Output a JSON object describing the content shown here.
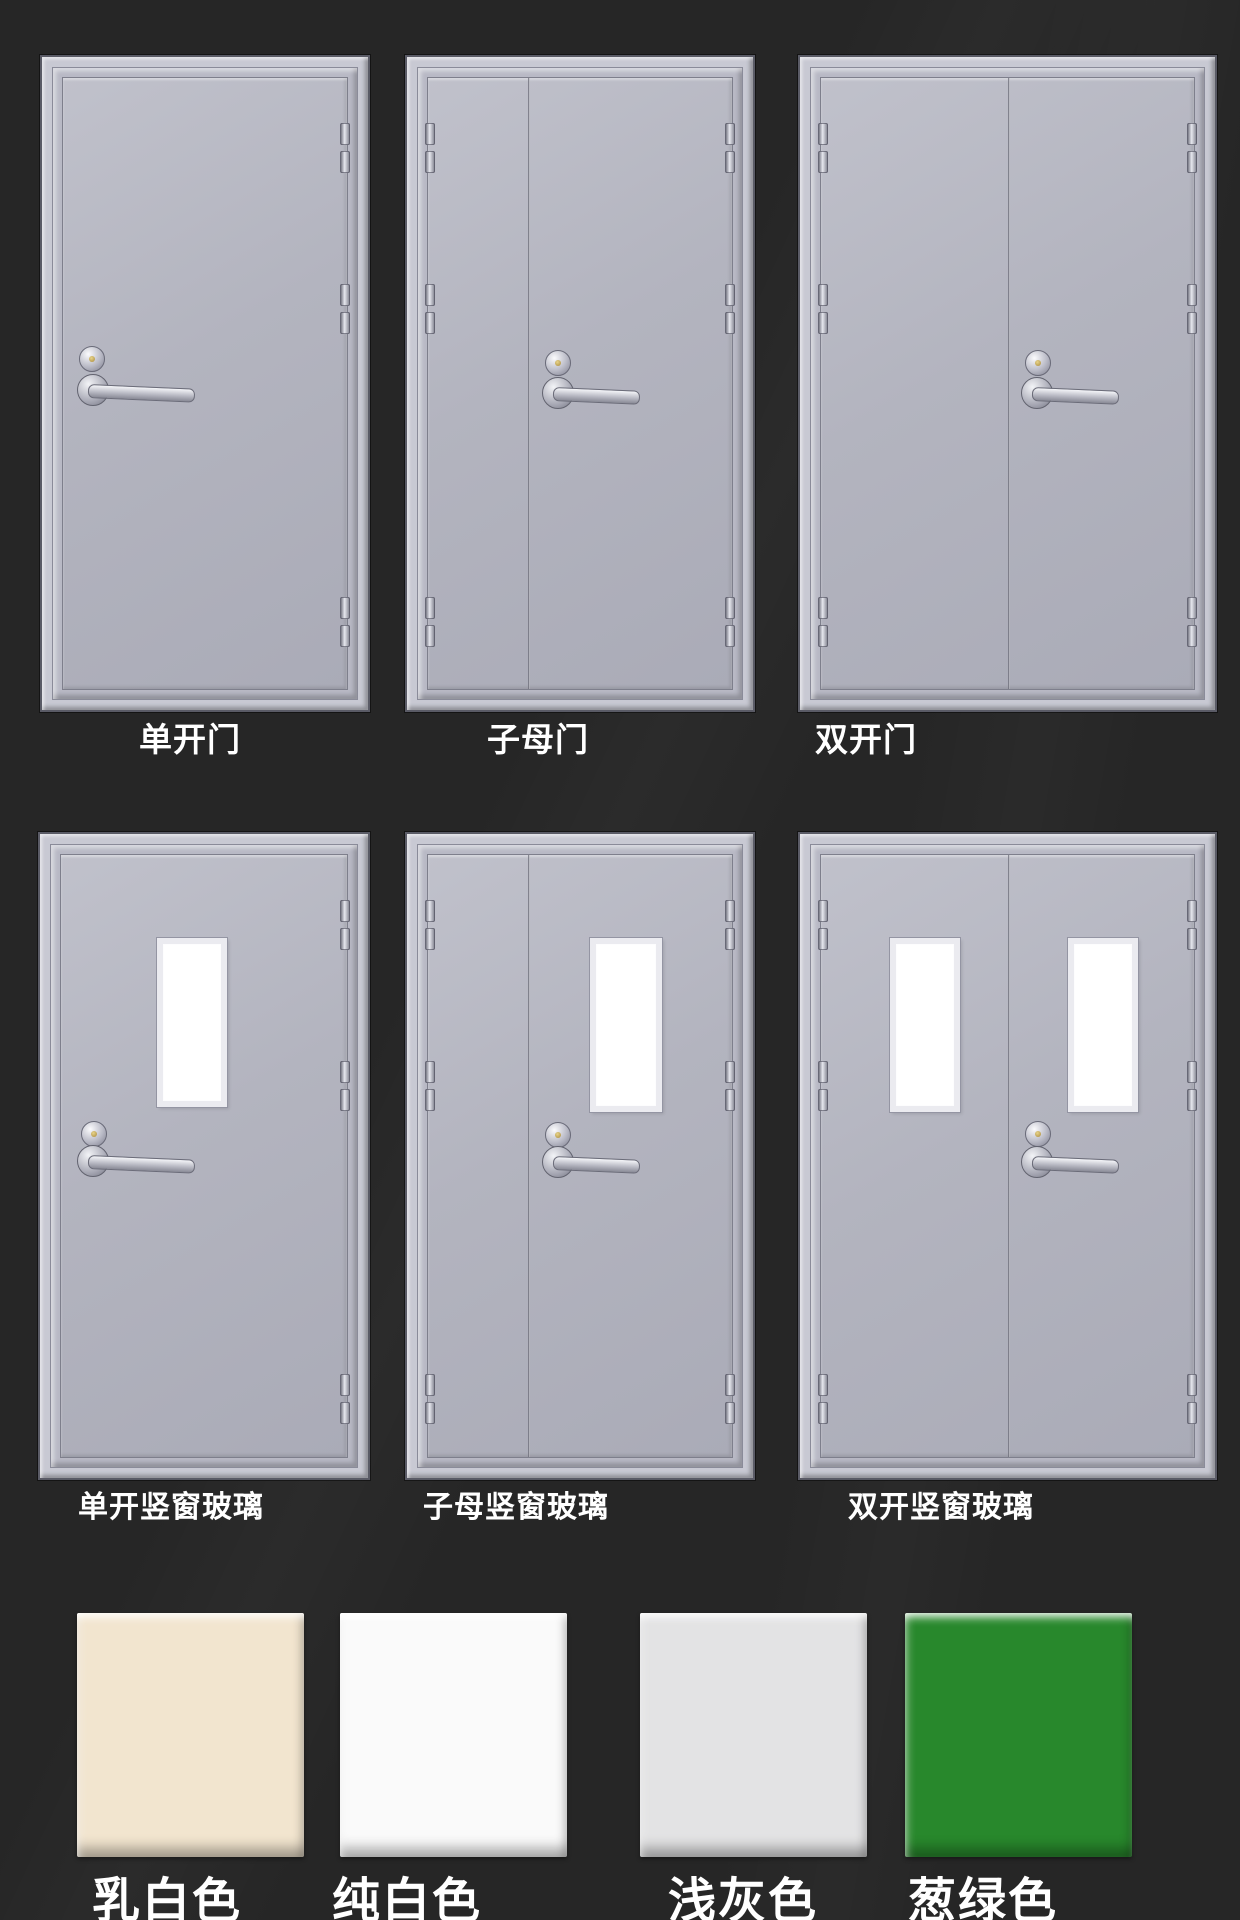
{
  "page": {
    "background": "#262626"
  },
  "doors": [
    {
      "id": "single",
      "label": "单开门",
      "type": "single",
      "glass": false
    },
    {
      "id": "mother-child",
      "label": "子母门",
      "type": "mother-child",
      "glass": false
    },
    {
      "id": "double",
      "label": "双开门",
      "type": "double",
      "glass": false
    },
    {
      "id": "single-glass",
      "label": "单开竖窗玻璃",
      "type": "single",
      "glass": true
    },
    {
      "id": "mother-child-glass",
      "label": "子母竖窗玻璃",
      "type": "mother-child",
      "glass": true
    },
    {
      "id": "double-glass",
      "label": "双开竖窗玻璃",
      "type": "double",
      "glass": true
    }
  ],
  "colors": [
    {
      "label": "乳白色",
      "hex": "#f2e5cf"
    },
    {
      "label": "纯白色",
      "hex": "#fafafa"
    },
    {
      "label": "浅灰色",
      "hex": "#e3e3e4"
    },
    {
      "label": "葱绿色",
      "hex": "#28882c"
    }
  ],
  "hardware": {
    "hinge": "door-hinge",
    "lock": "lock-cylinder",
    "handle": "lever-handle"
  }
}
